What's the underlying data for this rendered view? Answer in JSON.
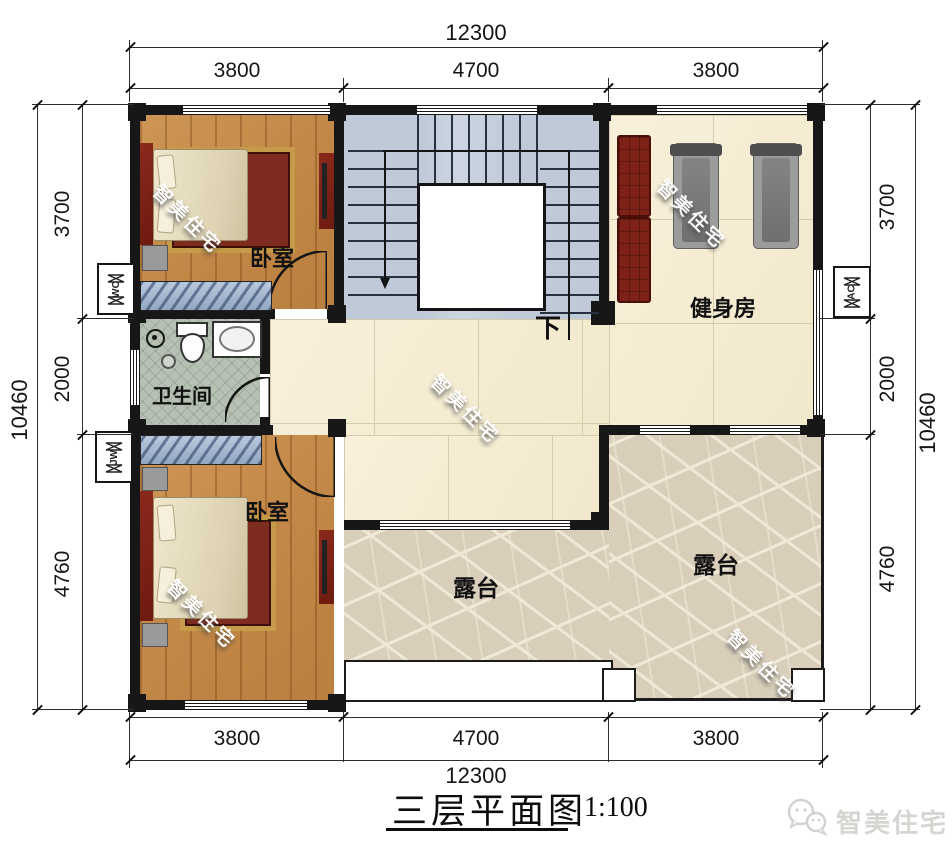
{
  "meta": {
    "title": "三层平面图",
    "scale": "1:100"
  },
  "brand": {
    "name": "智美住宅",
    "watermark": "智美住宅"
  },
  "dimensions": {
    "top": {
      "total": "12300",
      "segments": [
        "3800",
        "4700",
        "3800"
      ]
    },
    "bottom": {
      "total": "12300",
      "segments": [
        "3800",
        "4700",
        "3800"
      ]
    },
    "left": {
      "total": "10460",
      "segments": [
        "3700",
        "2000",
        "4760"
      ]
    },
    "right": {
      "total": "10460",
      "segments": [
        "3700",
        "2000",
        "4760"
      ]
    }
  },
  "rooms": {
    "bedroom_top": "卧室",
    "bedroom_bottom": "卧室",
    "gym": "健身房",
    "bathroom": "卫生间",
    "terrace_mid": "露台",
    "terrace_right": "露台",
    "stair_down": "下"
  },
  "shafts": {
    "left_top": "WC",
    "left_bottom": "JW",
    "right": "AC"
  },
  "colors": {
    "wall": "#171717",
    "wood_floor": "#c28746",
    "tile_floor": "#f6eed8",
    "stair_floor": "#c3cdda",
    "bath_floor": "#b6c1b3",
    "terrace_floor": "#d8ceba",
    "furniture_maroon": "#7c2318",
    "wardrobe_blue": "#a3b5cc"
  }
}
